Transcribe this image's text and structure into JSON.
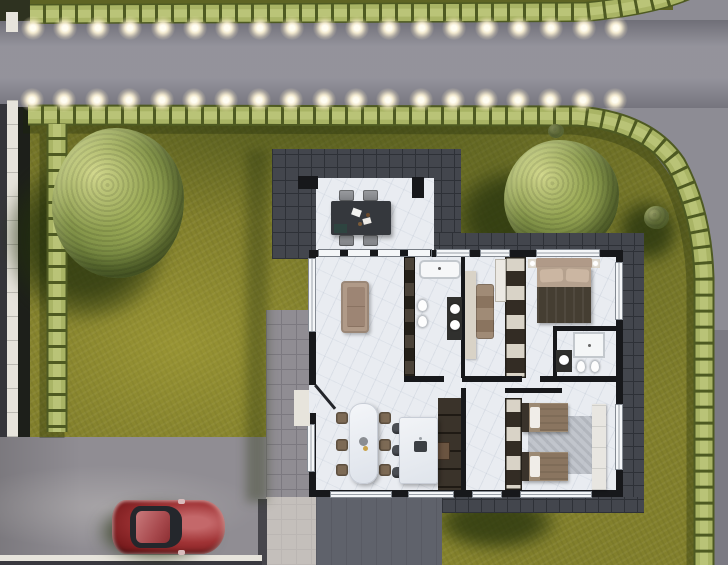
{
  "meta": {
    "title": "Aerial 3D site plan render of a single-storey house",
    "canvas_w": 728,
    "canvas_h": 565
  },
  "palette": {
    "road": "#8d8c94",
    "roadShade": "#77767e",
    "grass": "#82802c",
    "grassDark": "#5e6424",
    "shadow": "#3c481b",
    "hedge": "#a9b465",
    "hedgeDark": "#4e5a22",
    "hedgeHi": "#c9d289",
    "darkTile": "#43464d",
    "darkTileLine": "#2e3137",
    "paving": "#908d93",
    "pavingLine": "#7c7980",
    "pavingShade": "#5f626b",
    "sidewalk": "#e7e4dc",
    "floor": "#e9ecf1",
    "wall": "#17181b",
    "window": "#f4f6f8",
    "sofa": "#b09a88",
    "wood": "#7d6a55",
    "cream": "#d9d3c7",
    "blanketDark": "#453e32",
    "rug": "#b8bcc3",
    "stool": "#4b4e54",
    "tableDark": "#35383d",
    "carRed": "#8e2222",
    "glow": "#fff3d6"
  },
  "streetlights": {
    "rows": [
      {
        "y": 28,
        "x_start": 33,
        "count": 19,
        "spacing": 32.4
      },
      {
        "y": 100,
        "x_start": 32,
        "count": 19,
        "spacing": 32.4
      }
    ]
  },
  "scene": {
    "setting": "top-down architectural visualization, daylight, shadows cast to lower-left",
    "environment": {
      "roads": [
        "street-top-horizontal",
        "street-right-vertical-curving"
      ],
      "hedges": [
        "hedge-street-upper",
        "hedge-street-lower-curving-right",
        "hedge-left-boundary"
      ],
      "lawn": "olive-green lawn surrounding house",
      "trees": [
        "large-tree-left",
        "tree-right-of-terrace",
        "small-bush-near-right-hedge"
      ],
      "driveway": "gray driveway bottom-left with parked car",
      "walkway": "tiled walkway along left side of house",
      "car": {
        "name": "red-hatchback",
        "color": "#8e2222",
        "heading": "east"
      }
    },
    "house": {
      "terrace": {
        "floor": "white stone patio in dark tile apron",
        "furniture": [
          "dark-outdoor-dining-table",
          "4-gray-chairs",
          "2-black-columns"
        ]
      },
      "rooms": [
        {
          "name": "living-room",
          "furniture": [
            "tan-sofa"
          ]
        },
        {
          "name": "bathroom",
          "furniture": [
            "bathtub",
            "wall-hung-toilet",
            "bidet",
            "dark-vanity-2-round-sinks"
          ]
        },
        {
          "name": "dressing-room",
          "furniture": [
            "cream-console",
            "brown-chaise",
            "white-cabinet"
          ]
        },
        {
          "name": "master-bedroom",
          "furniture": [
            "double-bed-dark-blanket",
            "2-nightstands-with-lamps",
            "wardrobe-wall"
          ]
        },
        {
          "name": "ensuite-bathroom",
          "furniture": [
            "shower",
            "toilet",
            "bidet",
            "vanity"
          ]
        },
        {
          "name": "dining-room",
          "furniture": [
            "white-stone-dining-table",
            "6-brown-chairs"
          ]
        },
        {
          "name": "kitchen",
          "furniture": [
            "island-with-sink",
            "3-bar-stools",
            "tall-dark-cabinets",
            "oven-block"
          ]
        },
        {
          "name": "kids-bedroom",
          "furniture": [
            "single-bed",
            "single-bed",
            "gray-rug",
            "white-dresser",
            "wardrobe-wall"
          ]
        }
      ],
      "entrance": "open door on left wall with white threshold"
    }
  }
}
